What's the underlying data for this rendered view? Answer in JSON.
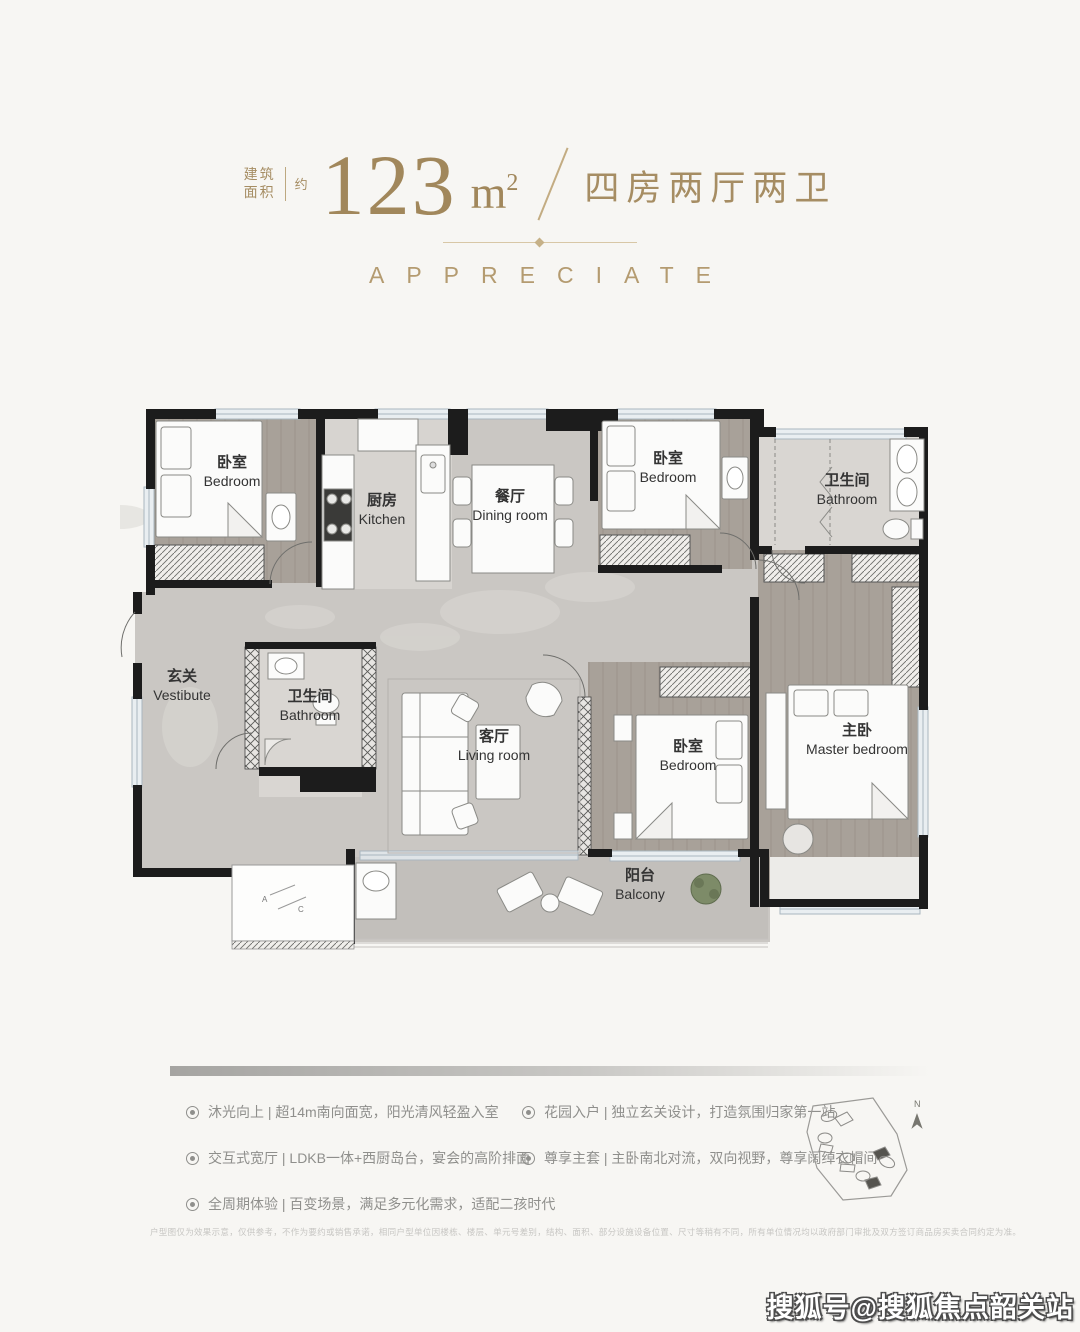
{
  "header": {
    "area_prefix": "建筑\n面积",
    "approx": "约",
    "area_value": "123",
    "area_unit_base": "m",
    "area_unit_sup": "2",
    "layout_text": "四房两厅两卫"
  },
  "subtitle": "APPRECIATE",
  "floorplan": {
    "rooms": [
      {
        "zh": "卧室",
        "en": "Bedroom"
      },
      {
        "zh": "厨房",
        "en": "Kitchen"
      },
      {
        "zh": "餐厅",
        "en": "Dining room"
      },
      {
        "zh": "卧室",
        "en": "Bedroom"
      },
      {
        "zh": "卫生间",
        "en": "Bathroom"
      },
      {
        "zh": "玄关",
        "en": "Vestibute"
      },
      {
        "zh": "卫生间",
        "en": "Bathroom"
      },
      {
        "zh": "客厅",
        "en": "Living room"
      },
      {
        "zh": "卧室",
        "en": "Bedroom"
      },
      {
        "zh": "主卧",
        "en": "Master bedroom"
      },
      {
        "zh": "阳台",
        "en": "Balcony"
      }
    ],
    "ac": [
      "A",
      "C"
    ]
  },
  "features": {
    "left": [
      "沐光向上 | 超14m南向面宽，阳光清风轻盈入室",
      "交互式宽厅 | LDKB一体+西厨岛台，宴会的高阶排面",
      "全周期体验 | 百变场景，满足多元化需求，适配二孩时代"
    ],
    "right": [
      "花园入户 | 独立玄关设计，打造氛围归家第一站",
      "尊享主套 | 主卧南北对流，双向视野，尊享阔绰衣帽间"
    ]
  },
  "sitemap": {
    "compass": "N"
  },
  "disclaimer": "户型图仅为效果示意，仅供参考，不作为要约或销售承诺，相同户型单位因楼栋、楼层、单元号差别，结构、面积、部分设施设备位置、尺寸等稍有不同，所有单位情况均以政府部门审批及双方签订商品房买卖合同约定为准。",
  "watermark": "搜狐号@搜狐焦点韶关站",
  "colors": {
    "gold": "#a68d63",
    "wall": "#1c1c1c",
    "marble": "#cac7c3",
    "wood": "#a8a199"
  }
}
